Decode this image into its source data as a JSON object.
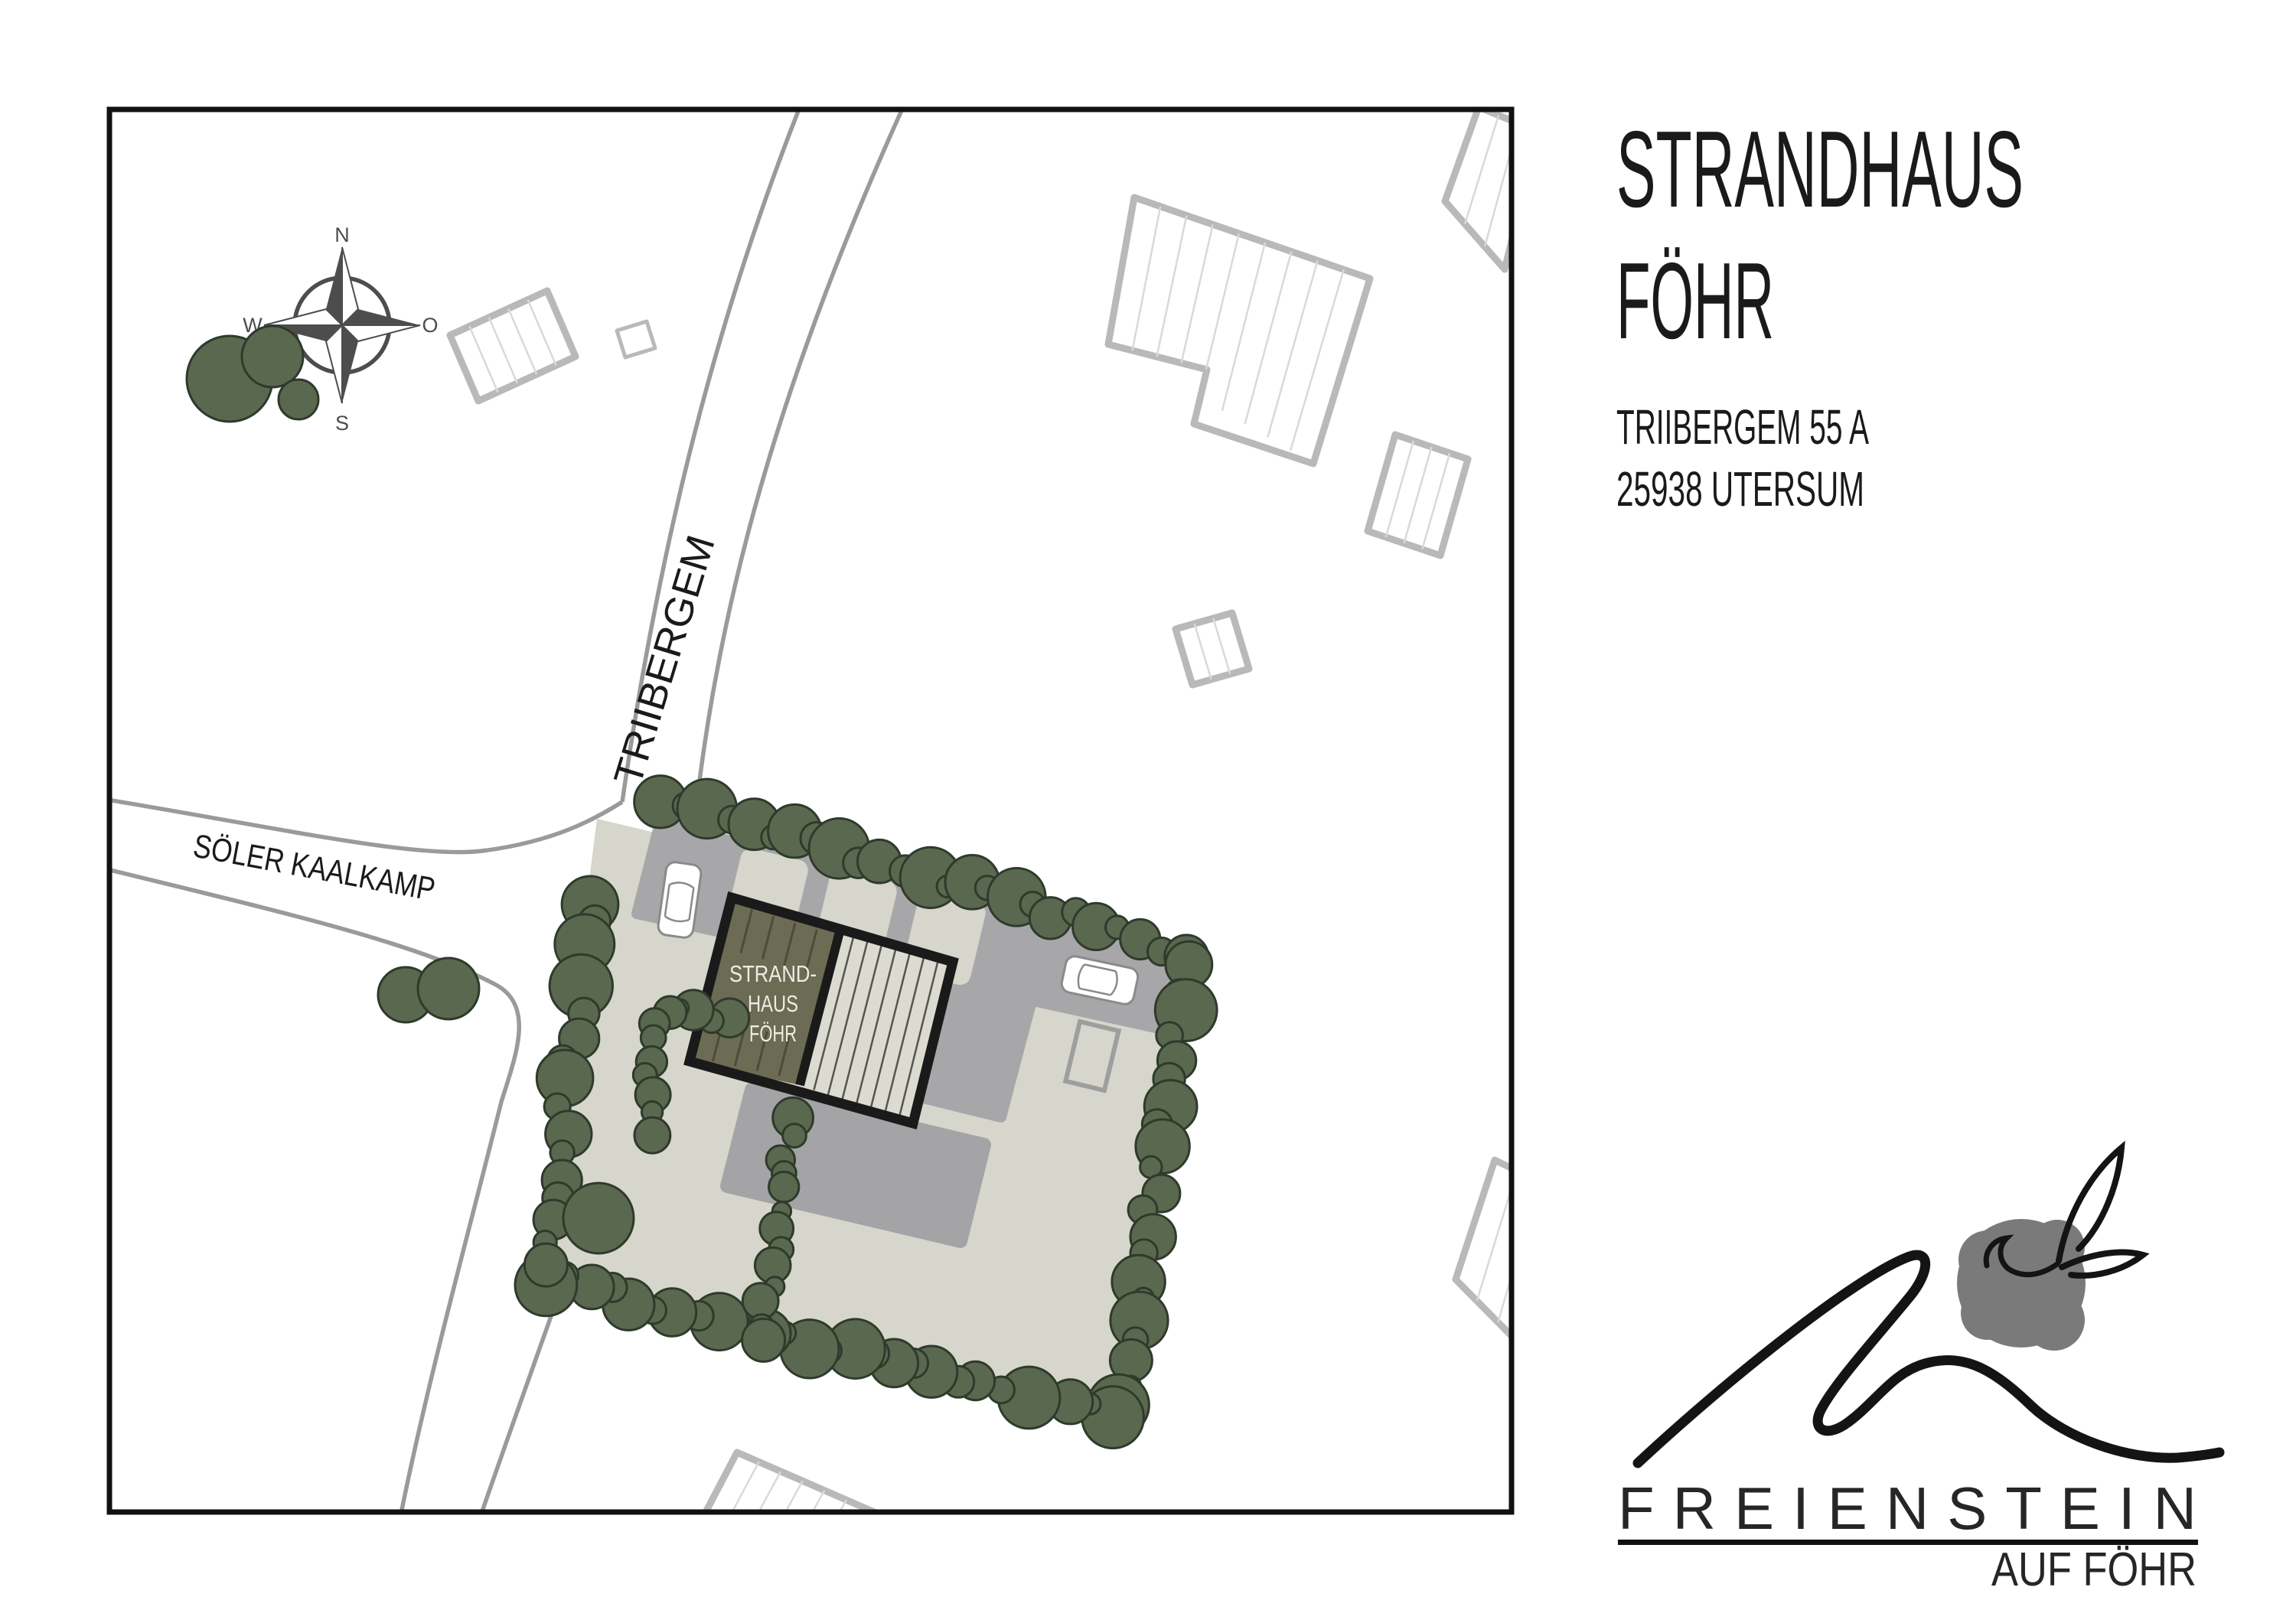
{
  "header": {
    "title_line1": "STRANDHAUS",
    "title_line2": "FÖHR",
    "address_line1": "TRIIBERGEM 55 A",
    "address_line2": "25938 UTERSUM"
  },
  "map": {
    "street_triibergem": "TRIIBERGEM",
    "street_soeler_kaalkamp": "SÖLER KAALKAMP",
    "building_label_line1": "STRAND-",
    "building_label_line2": "HAUS",
    "building_label_line3": "FÖHR",
    "compass_n": "N",
    "compass_o": "O",
    "compass_s": "S",
    "compass_w": "W"
  },
  "logo": {
    "wordmark": "FREIENSTEIN",
    "tagline": "AUF FÖHR"
  },
  "colors": {
    "ink": "#1a1a1a",
    "road": "#9a9a9a",
    "nb": "#b9b9b9",
    "nbstripe": "#d9d9d9",
    "tree": "#5a684f",
    "treeline": "#2e3a2b",
    "plot": "#d6d6cd",
    "drive": "#a7a7a9",
    "patio": "#a4a4a6",
    "bdark": "#6c6b54",
    "blight": "#dcdbd2",
    "bstripe_l": "#4d4c39",
    "bstripe_r": "#55554f",
    "btext": "#eeede1",
    "compass": "#4d4d4d",
    "blob": "#7a7a7a"
  }
}
